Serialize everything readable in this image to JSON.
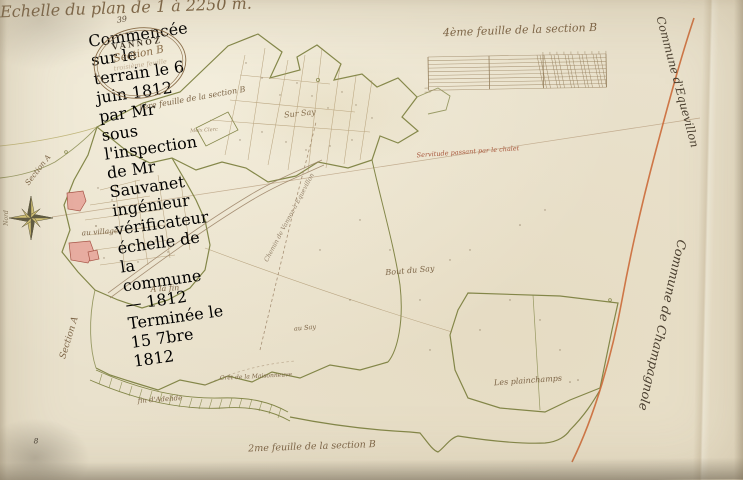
{
  "palette": {
    "paper": "#e9e1cc",
    "ink_dark": "#3f3425",
    "ink_sepia": "#8a6e4e",
    "boundary_olive": "#7b7f3e",
    "boundary_orange": "#c4683c",
    "building_pink": "#e7aca0"
  },
  "cartouche": {
    "folio_number": "39",
    "commune_title": "VANNOZ",
    "section_line": "Section B",
    "sheet_line": "troisième feuille",
    "note_lines": [
      "Commencée sur le terrain le 6 juin 1812 par Mr",
      "sous l'inspection de Mr Sauvanet ingénieur vérificateur",
      "échelle de la commune — 1812",
      "Terminée le 15 7bre 1812"
    ]
  },
  "scale": {
    "caption": "Echelle du plan de 1 à 2250 m."
  },
  "labels": [
    {
      "name": "folio-number",
      "text": "39",
      "x": 122,
      "y": 20,
      "rot": -8,
      "fs": 8,
      "color": "#5a4c3a"
    },
    {
      "name": "sheet-ref-top-left",
      "text": "1ère feuille de la section B",
      "x": 192,
      "y": 99,
      "rot": -10,
      "fs": 8
    },
    {
      "name": "sheet-ref-top",
      "text": "4ème feuille de la section B",
      "x": 520,
      "y": 30,
      "rot": -2,
      "fs": 11
    },
    {
      "name": "sheet-ref-bottom",
      "text": "2me feuille de la section B",
      "x": 312,
      "y": 447,
      "rot": -2,
      "fs": 9.5
    },
    {
      "name": "commune-equevillon",
      "text": "Commune d'Equevillon",
      "x": 677,
      "y": 82,
      "rot": 75,
      "fs": 11.5,
      "color": "#4a3f30"
    },
    {
      "name": "commune-champagnole",
      "text": "Commune de Champagnole",
      "x": 662,
      "y": 325,
      "rot": 103,
      "fs": 12.5,
      "color": "#4a3f30"
    },
    {
      "name": "section-a-left",
      "text": "Section A",
      "x": 70,
      "y": 338,
      "rot": -73,
      "fs": 9
    },
    {
      "name": "section-a-upper",
      "text": "Section A",
      "x": 38,
      "y": 170,
      "rot": -52,
      "fs": 7.5
    },
    {
      "name": "lieu-sur-say",
      "text": "Sur Say",
      "x": 300,
      "y": 114,
      "rot": -6,
      "fs": 8
    },
    {
      "name": "lieu-meix-clerc",
      "text": "Meix Clerc",
      "x": 204,
      "y": 131,
      "rot": -3,
      "fs": 5,
      "color": "#a08a6c"
    },
    {
      "name": "lieu-au-village",
      "text": "au village",
      "x": 100,
      "y": 232,
      "rot": -4,
      "fs": 7.5
    },
    {
      "name": "lieu-a-la-fin",
      "text": "A la fin",
      "x": 165,
      "y": 289,
      "rot": -3,
      "fs": 8
    },
    {
      "name": "lieu-bout-du-say",
      "text": "Bout du Say",
      "x": 410,
      "y": 271,
      "rot": -5,
      "fs": 8
    },
    {
      "name": "lieu-au-say",
      "text": "au Say",
      "x": 305,
      "y": 328,
      "rot": -5,
      "fs": 6.5
    },
    {
      "name": "lieu-maisonneuve",
      "text": "Crêt de la Maisonneuve",
      "x": 256,
      "y": 377,
      "rot": -3,
      "fs": 6
    },
    {
      "name": "lieu-fin-adelide",
      "text": "fin d'Adelide",
      "x": 160,
      "y": 400,
      "rot": -4,
      "fs": 7
    },
    {
      "name": "lieu-plainchamps",
      "text": "Les plainchamps",
      "x": 528,
      "y": 381,
      "rot": -4,
      "fs": 8
    },
    {
      "name": "annotation-chalet",
      "text": "Servitude passant par le chalet",
      "x": 468,
      "y": 152,
      "rot": -4,
      "fs": 6.5,
      "color": "#a8573c"
    },
    {
      "name": "road-label",
      "text": "Chemin de Vannoz à Equevillon",
      "x": 290,
      "y": 218,
      "rot": -62,
      "fs": 6.2,
      "color": "#95836b"
    },
    {
      "name": "north-label",
      "text": "Nord",
      "x": 7,
      "y": 218,
      "rot": -90,
      "fs": 6,
      "color": "#8a7a60"
    },
    {
      "name": "page-mark",
      "text": "8",
      "x": 36,
      "y": 441,
      "rot": 0,
      "fs": 7.5,
      "color": "#3f382e"
    }
  ]
}
